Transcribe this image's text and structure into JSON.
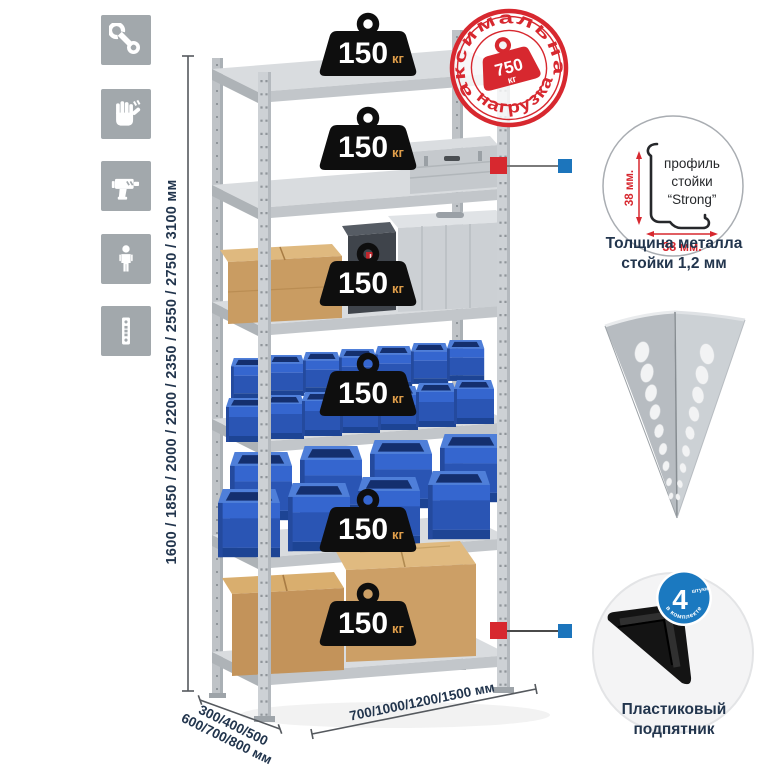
{
  "page": {
    "background": "#ffffff"
  },
  "toolbar_icons": [
    {
      "name": "wrench-icon"
    },
    {
      "name": "work-gloves-icon"
    },
    {
      "name": "drill-icon"
    },
    {
      "name": "person-icon"
    },
    {
      "name": "perforated-post-icon"
    }
  ],
  "height_dimension": {
    "label": "1600 / 1850 / 2000 / 2200 / 2350 / 2550 / 2750 / 3100 мм"
  },
  "rack": {
    "shelves_count": 6,
    "shelf_badges": [
      {
        "value": "150",
        "unit": "кг"
      },
      {
        "value": "150",
        "unit": "кг"
      },
      {
        "value": "150",
        "unit": "кг"
      },
      {
        "value": "150",
        "unit": "кг"
      },
      {
        "value": "150",
        "unit": "кг"
      },
      {
        "value": "150",
        "unit": "кг"
      }
    ]
  },
  "max_load_stamp": {
    "arc_top": "максимальная",
    "arc_bottom": "нагрузка",
    "value": "750",
    "unit": "кг"
  },
  "profile_detail": {
    "label_line1": "профиль",
    "label_line2": "стойки",
    "label_line3": "“Strong”",
    "vertical_dim": "38 мм.",
    "horizontal_dim": "38 мм.",
    "caption_line1": "Толщина металла",
    "caption_line2": "стойки 1,2 мм"
  },
  "foot_detail": {
    "badge_value": "4",
    "badge_small_text": "штуки",
    "badge_arc_text": "в комплекте",
    "caption_line1": "Пластиковый",
    "caption_line2": "подпятник"
  },
  "depth_dimension": {
    "line1": "300/400/500",
    "line2": "600/700/800 мм"
  },
  "width_dimension": {
    "label": "700/1000/1200/1500 мм"
  },
  "colors": {
    "accent_red": "#d7282f",
    "accent_blue": "#1c75bc",
    "bin_blue": "#2b59bb",
    "navy_text": "#22354d",
    "badge_black": "#0e0e0e",
    "kg_orange": "#e09e4a",
    "icon_tile_grey": "#a2a8ac",
    "metal_grey": "#c9cdd1"
  }
}
